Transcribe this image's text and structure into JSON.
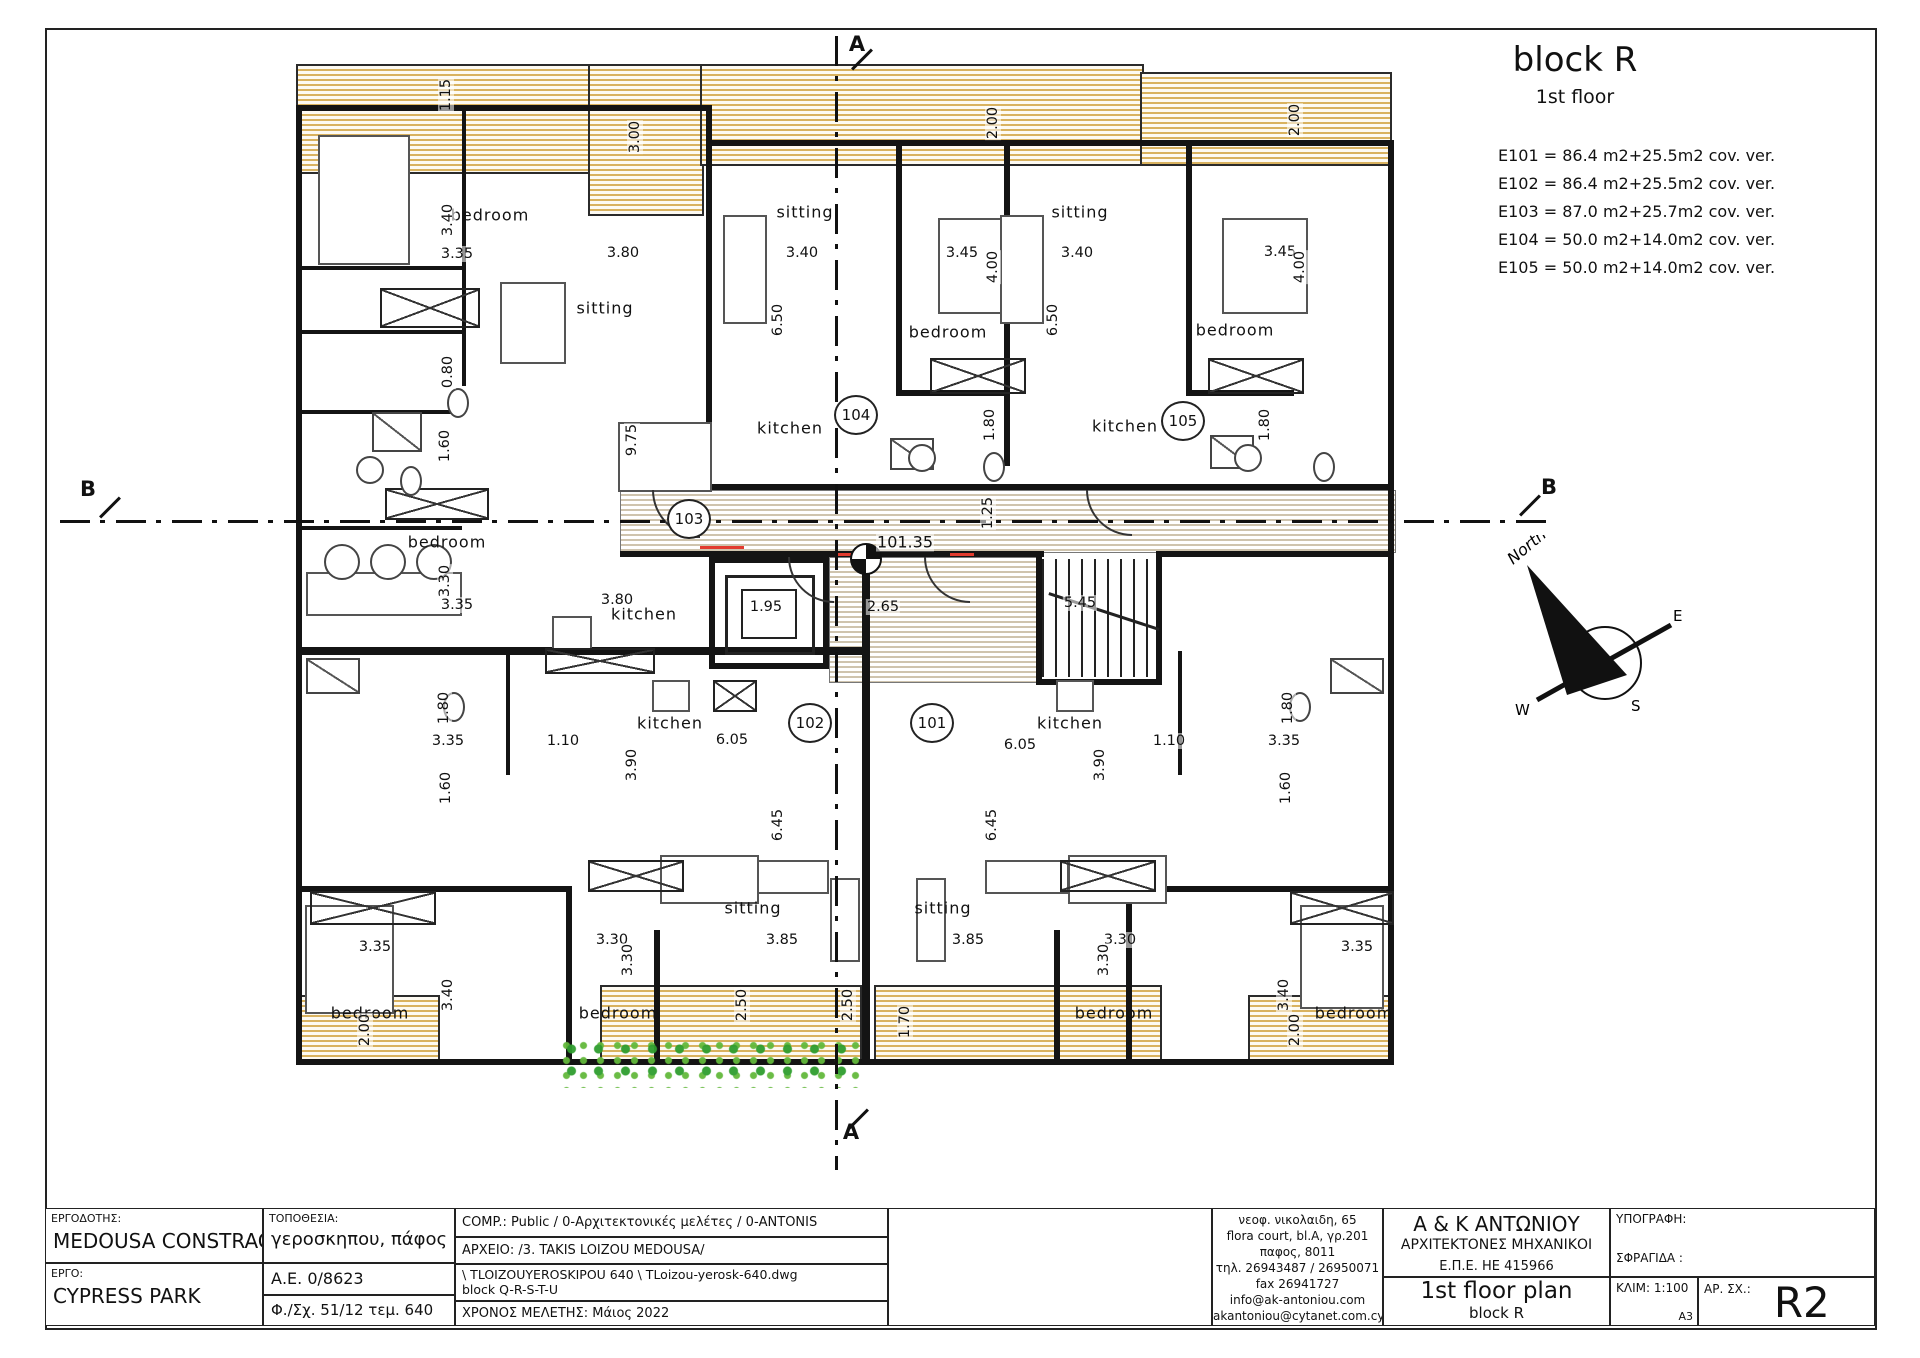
{
  "legend": {
    "title": "block R",
    "subtitle": "1st floor",
    "units": [
      "E101 = 86.4 m2+25.5m2 cov. ver.",
      "E102 = 86.4 m2+25.5m2 cov. ver.",
      "E103 = 87.0 m2+25.7m2 cov. ver.",
      "E104 = 50.0 m2+14.0m2 cov. ver.",
      "E105 = 50.0 m2+14.0m2 cov. ver."
    ]
  },
  "plan": {
    "level_label": "101.35",
    "rooms": [
      {
        "t": "bedroom",
        "x": 490,
        "y": 215
      },
      {
        "t": "sitting",
        "x": 605,
        "y": 308
      },
      {
        "t": "sitting",
        "x": 805,
        "y": 212
      },
      {
        "t": "bedroom",
        "x": 948,
        "y": 332
      },
      {
        "t": "kitchen",
        "x": 790,
        "y": 428
      },
      {
        "t": "sitting",
        "x": 1080,
        "y": 212
      },
      {
        "t": "bedroom",
        "x": 1235,
        "y": 330
      },
      {
        "t": "kitchen",
        "x": 1125,
        "y": 426
      },
      {
        "t": "bedroom",
        "x": 447,
        "y": 542
      },
      {
        "t": "kitchen",
        "x": 644,
        "y": 614
      },
      {
        "t": "kitchen",
        "x": 670,
        "y": 723
      },
      {
        "t": "kitchen",
        "x": 1070,
        "y": 723
      },
      {
        "t": "sitting",
        "x": 753,
        "y": 908
      },
      {
        "t": "sitting",
        "x": 943,
        "y": 908
      },
      {
        "t": "bedroom",
        "x": 370,
        "y": 1013
      },
      {
        "t": "bedroom",
        "x": 618,
        "y": 1013
      },
      {
        "t": "bedroom",
        "x": 1114,
        "y": 1013
      },
      {
        "t": "bedroom",
        "x": 1354,
        "y": 1013
      }
    ],
    "dims": [
      {
        "t": "3.35",
        "x": 457,
        "y": 254,
        "v": 0
      },
      {
        "t": "3.80",
        "x": 623,
        "y": 253,
        "v": 0
      },
      {
        "t": "3.40",
        "x": 802,
        "y": 253,
        "v": 0
      },
      {
        "t": "3.45",
        "x": 962,
        "y": 253,
        "v": 0
      },
      {
        "t": "3.40",
        "x": 1077,
        "y": 253,
        "v": 0
      },
      {
        "t": "3.45",
        "x": 1280,
        "y": 252,
        "v": 0
      },
      {
        "t": "3.35",
        "x": 457,
        "y": 605,
        "v": 0
      },
      {
        "t": "3.80",
        "x": 617,
        "y": 600,
        "v": 0
      },
      {
        "t": "1.95",
        "x": 766,
        "y": 607,
        "v": 0
      },
      {
        "t": "2.65",
        "x": 883,
        "y": 607,
        "v": 0
      },
      {
        "t": "5.45",
        "x": 1080,
        "y": 603,
        "v": 0
      },
      {
        "t": "3.35",
        "x": 448,
        "y": 741,
        "v": 0
      },
      {
        "t": "1.10",
        "x": 563,
        "y": 741,
        "v": 0
      },
      {
        "t": "6.05",
        "x": 732,
        "y": 740,
        "v": 0
      },
      {
        "t": "6.05",
        "x": 1020,
        "y": 745,
        "v": 0
      },
      {
        "t": "1.10",
        "x": 1169,
        "y": 741,
        "v": 0
      },
      {
        "t": "3.35",
        "x": 1284,
        "y": 741,
        "v": 0
      },
      {
        "t": "3.35",
        "x": 375,
        "y": 947,
        "v": 0
      },
      {
        "t": "3.30",
        "x": 612,
        "y": 940,
        "v": 0
      },
      {
        "t": "3.85",
        "x": 782,
        "y": 940,
        "v": 0
      },
      {
        "t": "3.85",
        "x": 968,
        "y": 940,
        "v": 0
      },
      {
        "t": "3.30",
        "x": 1120,
        "y": 940,
        "v": 0
      },
      {
        "t": "3.35",
        "x": 1357,
        "y": 947,
        "v": 0
      },
      {
        "t": "1.15",
        "x": 446,
        "y": 95,
        "v": 1
      },
      {
        "t": "3.00",
        "x": 635,
        "y": 137,
        "v": 1
      },
      {
        "t": "2.00",
        "x": 993,
        "y": 123,
        "v": 1
      },
      {
        "t": "2.00",
        "x": 1295,
        "y": 120,
        "v": 1
      },
      {
        "t": "3.40",
        "x": 448,
        "y": 220,
        "v": 1
      },
      {
        "t": "4.00",
        "x": 993,
        "y": 267,
        "v": 1
      },
      {
        "t": "4.00",
        "x": 1300,
        "y": 267,
        "v": 1
      },
      {
        "t": "6.50",
        "x": 778,
        "y": 320,
        "v": 1
      },
      {
        "t": "6.50",
        "x": 1053,
        "y": 320,
        "v": 1
      },
      {
        "t": "0.80",
        "x": 448,
        "y": 372,
        "v": 1
      },
      {
        "t": "1.60",
        "x": 445,
        "y": 446,
        "v": 1
      },
      {
        "t": "9.75",
        "x": 632,
        "y": 440,
        "v": 1
      },
      {
        "t": "1.80",
        "x": 990,
        "y": 425,
        "v": 1
      },
      {
        "t": "1.80",
        "x": 1265,
        "y": 425,
        "v": 1
      },
      {
        "t": "3.30",
        "x": 445,
        "y": 581,
        "v": 1
      },
      {
        "t": "1.25",
        "x": 988,
        "y": 513,
        "v": 1
      },
      {
        "t": "1.80",
        "x": 444,
        "y": 708,
        "v": 1
      },
      {
        "t": "1.60",
        "x": 446,
        "y": 788,
        "v": 1
      },
      {
        "t": "3.90",
        "x": 632,
        "y": 765,
        "v": 1
      },
      {
        "t": "3.90",
        "x": 1100,
        "y": 765,
        "v": 1
      },
      {
        "t": "1.80",
        "x": 1288,
        "y": 708,
        "v": 1
      },
      {
        "t": "1.60",
        "x": 1286,
        "y": 788,
        "v": 1
      },
      {
        "t": "6.45",
        "x": 778,
        "y": 825,
        "v": 1
      },
      {
        "t": "6.45",
        "x": 992,
        "y": 825,
        "v": 1
      },
      {
        "t": "3.30",
        "x": 628,
        "y": 960,
        "v": 1
      },
      {
        "t": "3.30",
        "x": 1104,
        "y": 960,
        "v": 1
      },
      {
        "t": "3.40",
        "x": 448,
        "y": 995,
        "v": 1
      },
      {
        "t": "3.40",
        "x": 1284,
        "y": 995,
        "v": 1
      },
      {
        "t": "2.00",
        "x": 365,
        "y": 1030,
        "v": 1
      },
      {
        "t": "2.50",
        "x": 742,
        "y": 1005,
        "v": 1
      },
      {
        "t": "2.50",
        "x": 848,
        "y": 1005,
        "v": 1
      },
      {
        "t": "1.70",
        "x": 905,
        "y": 1022,
        "v": 1
      },
      {
        "t": "2.00",
        "x": 1295,
        "y": 1030,
        "v": 1
      }
    ],
    "circles": [
      {
        "t": "101",
        "x": 932,
        "y": 723
      },
      {
        "t": "102",
        "x": 810,
        "y": 723
      },
      {
        "t": "103",
        "x": 689,
        "y": 519
      },
      {
        "t": "104",
        "x": 856,
        "y": 415
      },
      {
        "t": "105",
        "x": 1183,
        "y": 421
      }
    ],
    "sections": [
      {
        "t": "A",
        "x": 857,
        "y": 44
      },
      {
        "t": "A",
        "x": 851,
        "y": 1132
      },
      {
        "t": "B",
        "x": 88,
        "y": 489
      },
      {
        "t": "B",
        "x": 1549,
        "y": 487
      }
    ],
    "compass": {
      "north": "North",
      "w": "W",
      "e": "E",
      "s": "S"
    }
  },
  "titleblock": {
    "employer_label": "ΕΡΓΟΔΟΤΗΣ:",
    "employer": "MEDOUSA CONSTRACTION LTD",
    "project_label": "ΕΡΓΟ:",
    "project": "CYPRESS PARK",
    "location_label": "ΤΟΠΟΘΕΣΙΑ:",
    "location": "γεροσκηπου, πάφος",
    "ae": "Α.Ε.  0/8623",
    "sheet_ref": "Φ./Σχ. 51/12  τεμ. 640",
    "comp": "COMP.: Public / 0-Αρχιτεκτονικές μελέτες / 0-ANTONIS",
    "archive": "ΑΡΧΕΙΟ: /3. TAKIS LOIZOU MEDOUSA/",
    "file_line1": "\\ TLOIZOUYEROSKIPOU 640 \\ TLoizou-yerosk-640.dwg",
    "file_line2": "block Q-R-S-T-U",
    "study_time": "ΧΡΟΝΟΣ ΜΕΛΕΤΗΣ: Μάιος 2022",
    "address_lines": [
      "νεοφ. νικολαιδη, 65",
      "flora court,  bl.A, γρ.201",
      "παφος, 8011",
      "τηλ. 26943487 / 26950071",
      "fax  26941727",
      "info@ak-antoniou.com",
      "akantoniou@cytanet.com.cy"
    ],
    "firm_lines": [
      "A & K ΑΝΤΩΝΙΟΥ",
      "ΑΡΧΙΤΕΚΤΟΝΕΣ ΜΗΧΑΝΙΚΟΙ",
      "Ε.Π.Ε.    HE 415966"
    ],
    "signature_label": "ΥΠΟΓΡΑΦΗ:",
    "stamp_label": "ΣΦΡΑΓΙΔΑ :",
    "drawing_title": "1st floor plan",
    "drawing_subtitle": "block R",
    "scale_label": "ΚΛΙΜ: 1:100",
    "paper": "A3",
    "sheet_no_label": "ΑΡ. ΣΧ.:",
    "sheet_no": "R2"
  }
}
